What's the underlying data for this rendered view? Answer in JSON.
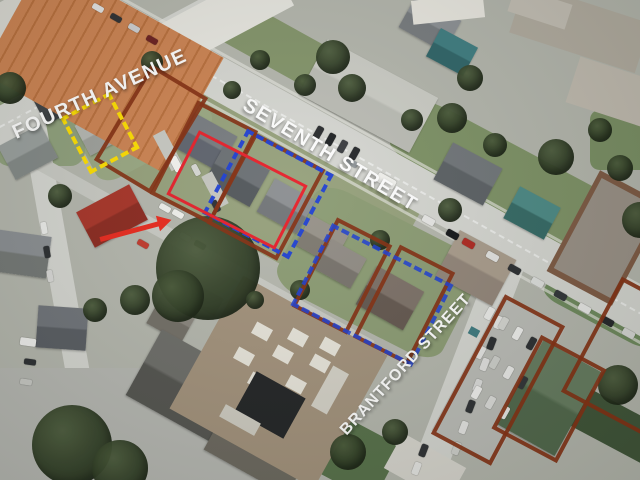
{
  "image": {
    "kind": "annotated aerial drone photograph",
    "subject": "residential neighbourhood land-assembly parcels",
    "width_px": 640,
    "height_px": 480
  },
  "street_labels": {
    "fourth_avenue": "FOURTH AVENUE",
    "seventh_street": "SEVENTH STREET",
    "brantford_street": "BRANTFORD STREET"
  },
  "annotations": {
    "colors": {
      "parcel_outline_maroon": "#843012",
      "highlight_yellow": "#ffdf00",
      "highlight_red": "#e6212b",
      "highlight_blue": "#1d3fd6",
      "arrow_red": "#ea2a1e",
      "street_label_text": "#ffffff"
    },
    "outlines": [
      {
        "name": "maroon-parcel-outline-1",
        "stroke": "solid"
      },
      {
        "name": "maroon-parcel-outline-2",
        "stroke": "solid"
      },
      {
        "name": "maroon-parcel-outline-3",
        "stroke": "solid"
      },
      {
        "name": "maroon-parcel-outline-4",
        "stroke": "solid"
      },
      {
        "name": "maroon-parcel-outline-5",
        "stroke": "solid"
      },
      {
        "name": "maroon-parcel-outline-6",
        "stroke": "solid"
      },
      {
        "name": "maroon-parcel-outline-7",
        "stroke": "solid"
      },
      {
        "name": "maroon-parcel-outline-8",
        "stroke": "solid"
      },
      {
        "name": "yellow-dashed-lot-outline",
        "stroke": "dashed"
      },
      {
        "name": "red-solid-lot-outline",
        "stroke": "solid"
      },
      {
        "name": "blue-dashed-lot-outline-upper",
        "stroke": "dashed"
      },
      {
        "name": "blue-dashed-lot-outline-lower",
        "stroke": "dashed"
      },
      {
        "name": "red-pointer-arrow",
        "stroke": "arrow"
      }
    ]
  }
}
